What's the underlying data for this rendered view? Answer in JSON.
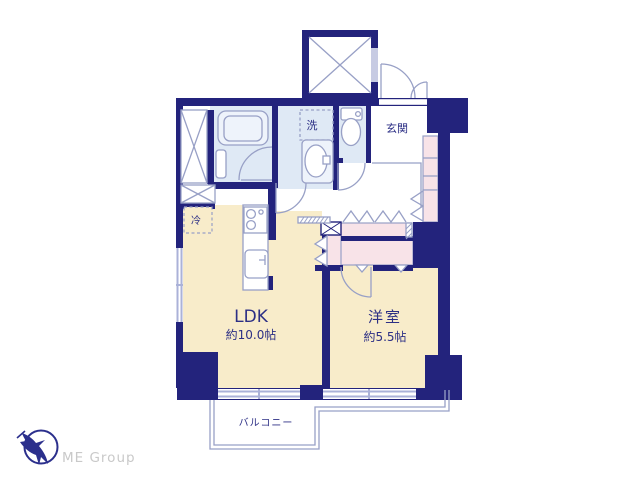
{
  "plan": {
    "rooms": {
      "ldk": {
        "name": "LDK",
        "size": "約10.0帖"
      },
      "bedroom": {
        "name": "洋室",
        "size": "約5.5帖"
      },
      "entrance": {
        "name": "玄関"
      },
      "balcony": {
        "name": "バルコニー"
      }
    },
    "fixtures": {
      "washer_label": "洗",
      "fridge_label": "冷"
    }
  },
  "branding": {
    "logo_text": "ME Group"
  },
  "colors": {
    "wall_navy": "#23237c",
    "room_floor_beige": "#f8ecca",
    "wet_area_blue": "#dfe9f5",
    "closet_pink": "#f8e3e8",
    "fixture_line": "#98a0c6",
    "window_lavender": "#abb2d8",
    "label_text": "#2c2f85",
    "logo_blue": "#2b2f8c",
    "logo_gray": "#c9c9c9"
  }
}
